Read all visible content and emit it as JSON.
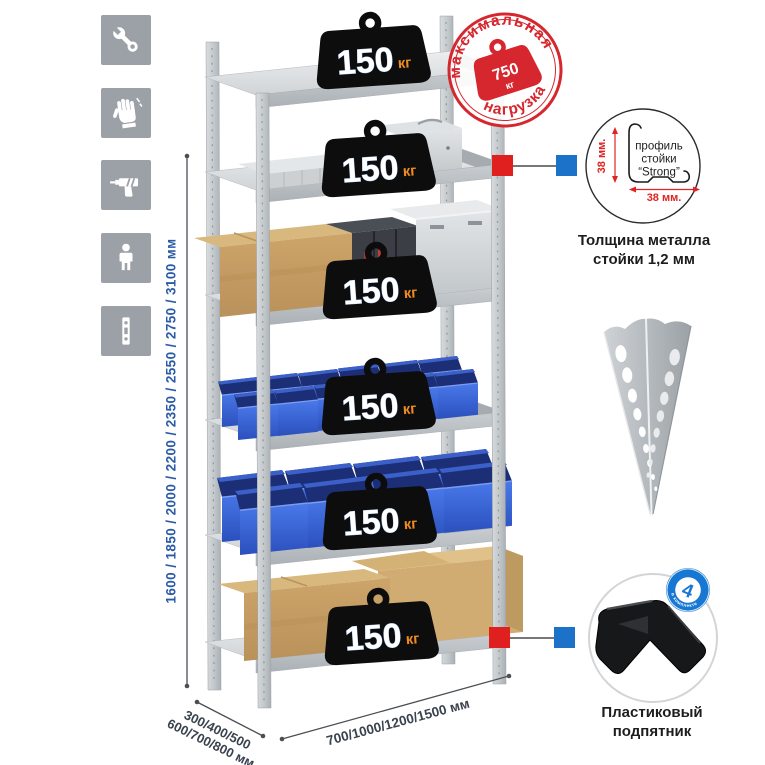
{
  "page": {
    "background": "#ffffff"
  },
  "sidebar": {
    "icons": [
      {
        "name": "wrench-icon"
      },
      {
        "name": "gloves-icon"
      },
      {
        "name": "drill-icon"
      },
      {
        "name": "person-icon"
      },
      {
        "name": "post-strip-icon"
      }
    ]
  },
  "dimensions": {
    "height_label": "1600 / 1850 / 2000 / 2200 / 2350 / 2550 / 2750 / 3100 мм",
    "depth_label_line1": "300/400/500",
    "depth_label_line2": "600/700/800 мм",
    "width_label": "700/1000/1200/1500 мм"
  },
  "shelf_badge": {
    "value": "150",
    "unit": "кг"
  },
  "max_load_stamp": {
    "arc_top": "максимальная",
    "arc_bottom": "нагрузка",
    "value": "750",
    "unit": "кг"
  },
  "profile_detail": {
    "label_line1": "профиль",
    "label_line2": "стойки",
    "label_line3": "“Strong”",
    "dim_vertical": "38 мм.",
    "dim_horizontal": "38 мм.",
    "caption_line1": "Толщина металла",
    "caption_line2": "стойки 1,2 мм"
  },
  "foot_detail": {
    "badge_value": "4",
    "badge_ring_text": "в комплекте",
    "caption_line1": "Пластиковый",
    "caption_line2": "подпятник"
  },
  "colors": {
    "accent_red": "#d6262e",
    "connector_blue": "#1b72c8",
    "connector_red": "#e01f1f",
    "dim_text_blue": "#2b5aa7",
    "bin_blue": "#2f5fd0",
    "icon_tile_gray": "#9ba1a7"
  }
}
